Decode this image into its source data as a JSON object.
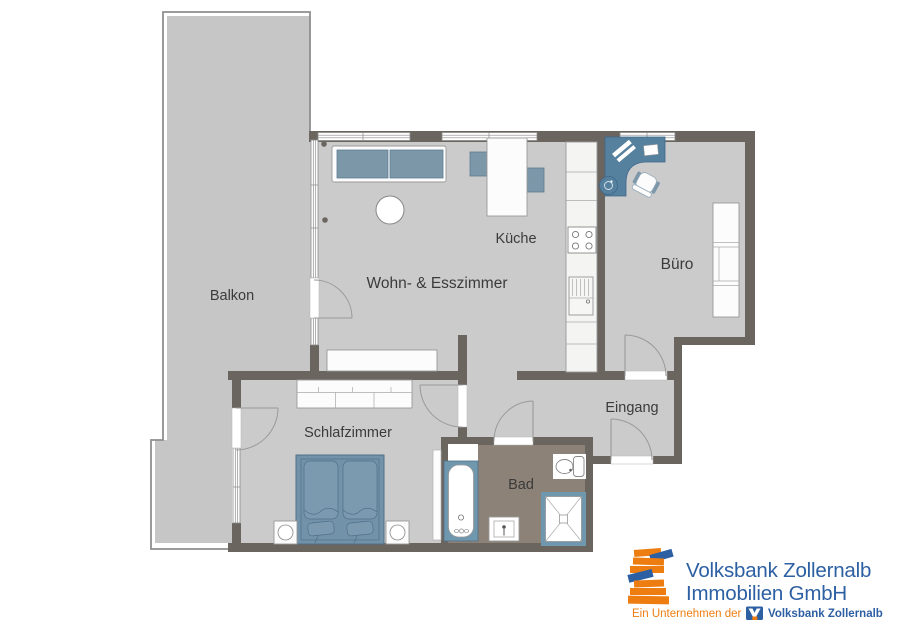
{
  "plan": {
    "rooms": {
      "balkon": {
        "label": "Balkon"
      },
      "wohnzimmer": {
        "label": "Wohn- & Esszimmer"
      },
      "kueche": {
        "label": "Küche"
      },
      "buero": {
        "label": "Büro"
      },
      "schlafzimmer": {
        "label": "Schlafzimmer"
      },
      "bad": {
        "label": "Bad"
      },
      "eingang": {
        "label": "Eingang"
      }
    },
    "colors": {
      "wall": "#6b655f",
      "floor": "#cbcbcb",
      "balcony_floor": "#c6c6c6",
      "bathroom_floor": "#8d8277",
      "furniture_blue": "#7b97a8",
      "desk_blue": "#55809e",
      "sanitary_blue": "#6f97ad",
      "label_text": "#3b3b3b"
    }
  },
  "logo": {
    "line1": "Volksbank Zollernalb",
    "line2": "Immobilien GmbH",
    "tagline_prefix": "Ein Unternehmen der",
    "tagline_brand": "Volksbank Zollernalb",
    "blue": "#2d5fa3",
    "orange": "#ee7d11"
  }
}
